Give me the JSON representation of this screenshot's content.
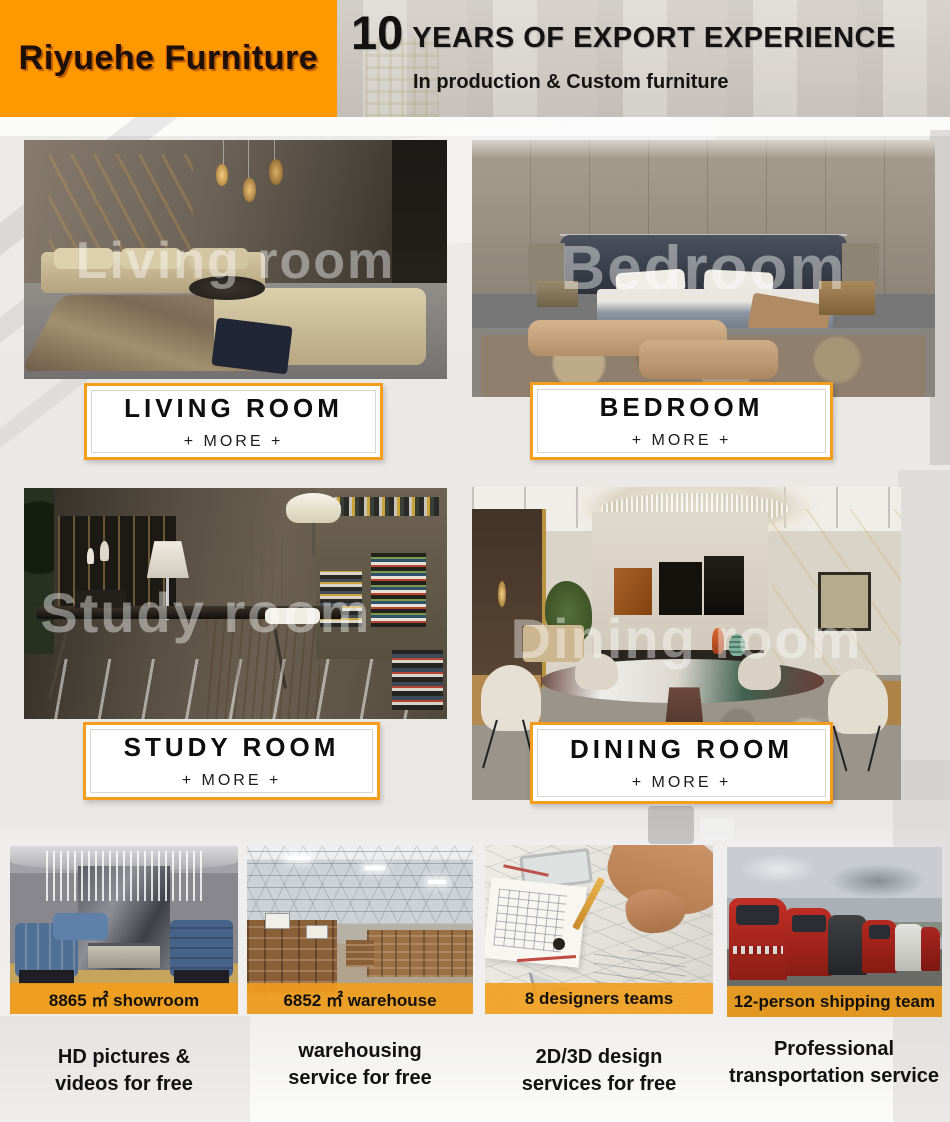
{
  "header": {
    "brand": "Riyuehe Furniture",
    "years_number": "10",
    "years_title": "YEARS OF EXPORT EXPERIENCE",
    "subtitle": "In production & Custom furniture",
    "brand_bg_color": "#FF9902"
  },
  "accent_color": "#F59E1E",
  "categories": [
    {
      "label": "LIVING ROOM",
      "more_label": "+ MORE +",
      "watermark": "Living room"
    },
    {
      "label": "BEDROOM",
      "more_label": "+ MORE +",
      "watermark": "Bedroom"
    },
    {
      "label": "STUDY ROOM",
      "more_label": "+ MORE +",
      "watermark": "Study room"
    },
    {
      "label": "DINING ROOM",
      "more_label": "+ MORE +",
      "watermark": "Dining room"
    }
  ],
  "services": [
    {
      "badge": "8865 ㎡ showroom",
      "desc_line1": "HD pictures &",
      "desc_line2": "videos for free"
    },
    {
      "badge": "6852 ㎡ warehouse",
      "desc_line1": "warehousing",
      "desc_line2": "service for free"
    },
    {
      "badge": "8 designers teams",
      "desc_line1": "2D/3D design",
      "desc_line2": "services for free"
    },
    {
      "badge": "12-person shipping team",
      "desc_line1": "Professional",
      "desc_line2": "transportation service"
    }
  ]
}
